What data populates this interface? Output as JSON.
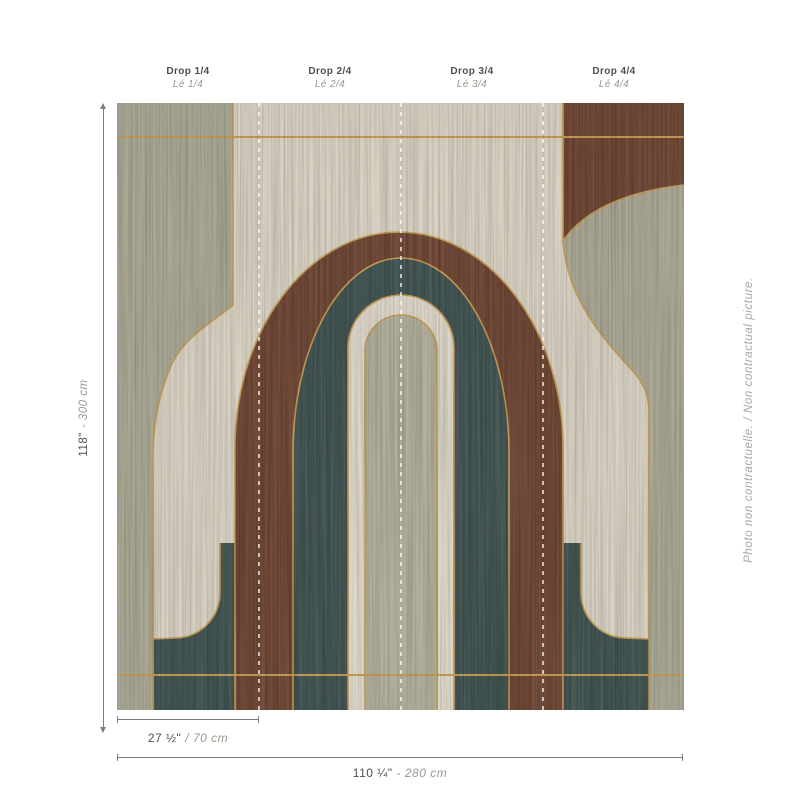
{
  "artwork": {
    "description": "Art-deco arches wallpaper mural preview, wood marquetry style, 4 vertical drops",
    "panels": 4
  },
  "colors": {
    "cream": "#d7d0c1",
    "cream_light": "#ddd7c9",
    "sage": "#a8a692",
    "sage_light": "#b0ae9a",
    "teal": "#3f5250",
    "brown": "#6d4533",
    "gold": "#c49a52",
    "text_dark": "#4f4f4d",
    "text_light": "#98988f"
  },
  "header": {
    "drops": [
      {
        "drop": "Drop 1/4",
        "le": "Lé 1/4"
      },
      {
        "drop": "Drop 2/4",
        "le": "Lé 2/4"
      },
      {
        "drop": "Drop 3/4",
        "le": "Lé 3/4"
      },
      {
        "drop": "Drop 4/4",
        "le": "Lé 4/4"
      }
    ]
  },
  "dimensions": {
    "height": {
      "value": "118\"",
      "alt": "- 300 cm"
    },
    "drop_width": {
      "value": "27 ½\"",
      "alt": "/ 70 cm"
    },
    "total_width": {
      "value": "110 ¼\"",
      "alt": "- 280 cm"
    }
  },
  "watermark": "Photo non contractuelle. / Non contractual picture."
}
